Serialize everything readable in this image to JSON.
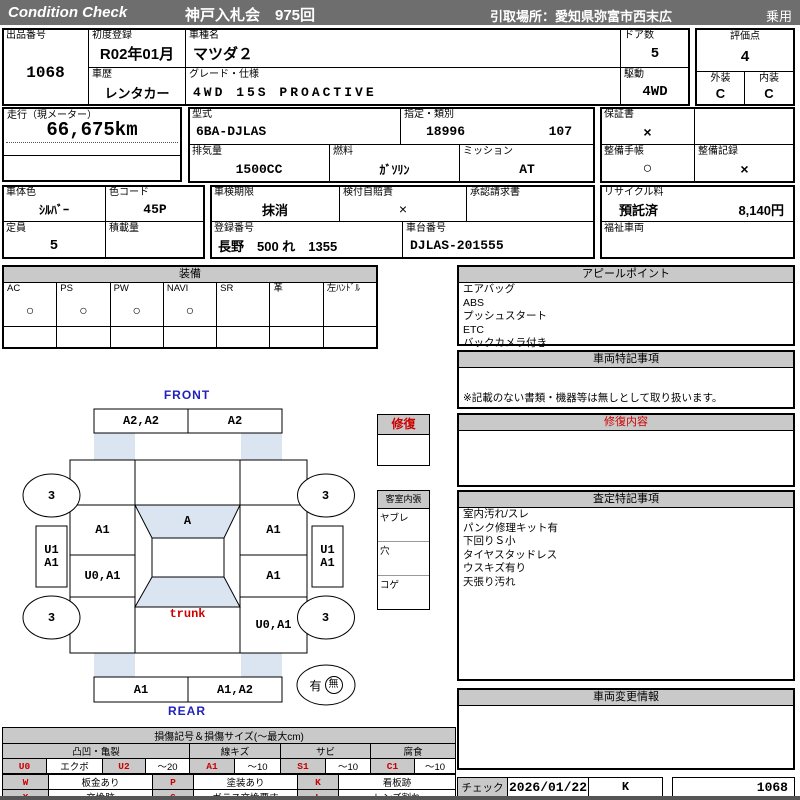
{
  "topbar": {
    "brand": "Condition  Check",
    "auction": "神戸入札会　975回",
    "pickup": "引取場所：愛知県弥富市西末広",
    "category": "乗用"
  },
  "row1": {
    "lot_label": "出品番号",
    "lot": "1068",
    "first_reg_label": "初度登録",
    "first_reg": "R02年01月",
    "history_label": "車歴",
    "history": "レンタカー",
    "model_label": "車種名",
    "model": "マツダ２",
    "grade_label": "グレード・仕様",
    "grade": "4WD 15S PROACTIVE",
    "doors_label": "ドア数",
    "doors": "5",
    "drive_label": "駆動",
    "drive": "4WD",
    "score_label": "評価点",
    "score": "4",
    "exterior_label": "外装",
    "exterior": "C",
    "interior_label": "内装",
    "interior": "C"
  },
  "row2": {
    "mileage_label": "走行（現メーター）",
    "mileage": "66,675km",
    "model_code_label": "型式",
    "model_code": "6BA-DJLAS",
    "class_label": "指定・類別",
    "class1": "18996",
    "class2": "107",
    "displacement_label": "排気量",
    "displacement": "1500CC",
    "fuel_label": "燃料",
    "fuel": "ｶﾞｿﾘﾝ",
    "mission_label": "ミッション",
    "mission": "AT",
    "warranty_label": "保証書",
    "warranty": "×",
    "book_label": "整備手帳",
    "book": "○",
    "record_label": "整備記録",
    "record": "×"
  },
  "row3": {
    "body_color_label": "車体色",
    "body_color": "ｼﾙﾊﾞｰ",
    "color_code_label": "色コード",
    "color_code": "45P",
    "capacity_label": "定員",
    "capacity": "5",
    "load_label": "積載量",
    "inspection_label": "車検期限",
    "inspection": "抹消",
    "insurance_label": "検付自賠責",
    "insurance": "×",
    "approval_label": "承認請求書",
    "plate_label": "登録番号",
    "plate": "長野　500 れ　1355",
    "chassis_label": "車台番号",
    "chassis": "DJLAS-201555",
    "recycle_label": "リサイクル料",
    "recycle_status": "預託済",
    "recycle_fee": "8,140円",
    "welfare_label": "福祉車両"
  },
  "equipment": {
    "title": "装備",
    "items": [
      {
        "label": "AC",
        "mark": "○"
      },
      {
        "label": "PS",
        "mark": "○"
      },
      {
        "label": "PW",
        "mark": "○"
      },
      {
        "label": "NAVI",
        "mark": "○"
      },
      {
        "label": "SR",
        "mark": ""
      },
      {
        "label": "革",
        "mark": ""
      },
      {
        "label": "左ﾊﾝﾄﾞﾙ",
        "mark": ""
      }
    ]
  },
  "panels": {
    "appeal": {
      "title": "アピールポイント",
      "items": [
        "エアバッグ",
        "ABS",
        "プッシュスタート",
        "ETC",
        "バックカメラ付き"
      ]
    },
    "notes": {
      "title": "車両特記事項",
      "note": "※記載のない書類・機器等は無しとして取り扱います。"
    },
    "repair": {
      "title": "修復内容"
    },
    "assessment": {
      "title": "査定特記事項",
      "items": [
        "室内汚れ/スレ",
        "パンク修理キット有",
        "下回りＳ小",
        "タイヤスタッドレス",
        "ウスキズ有り",
        "天張り汚れ"
      ]
    },
    "change": {
      "title": "車両変更情報"
    }
  },
  "check": {
    "label": "チェック",
    "date": "2026/01/22",
    "inspector": "K",
    "number": "1068"
  },
  "diagram": {
    "front": "FRONT",
    "rear": "REAR",
    "front_bumper_left": "A2,A2",
    "front_bumper_right": "A2",
    "rear_bumper_left": "A1",
    "rear_bumper_right": "A1,A2",
    "wheel_front_left": "3",
    "wheel_front_right": "3",
    "wheel_rear_left": "3",
    "wheel_rear_right": "3",
    "side_left_top": "U1",
    "side_left_bottom": "A1",
    "side_right_top": "U1",
    "side_right_bottom": "A1",
    "front_fender_left": "A1",
    "windshield": "A",
    "front_fender_right": "A1",
    "door_left": "U0,A1",
    "door_right": "A1",
    "trunk": "trunk",
    "rear_fender_right": "U0,A1",
    "presence_yes": "有",
    "presence_no": "無",
    "repair_box_title": "修復",
    "cabin_title": "客室内張",
    "cabin_items": [
      "ヤブレ",
      "穴",
      "コゲ"
    ]
  },
  "legend": {
    "title": "損傷記号＆損傷サイズ(～最大cm)",
    "groups": [
      "凸凹・亀裂",
      "線キズ",
      "サビ",
      "腐食"
    ],
    "row1": [
      {
        "code": "U0",
        "desc": "エクボ"
      },
      {
        "code": "U2",
        "desc": "～20"
      },
      {
        "code": "A1",
        "desc": "～10"
      },
      {
        "code": "S1",
        "desc": "～10"
      },
      {
        "code": "C1",
        "desc": "～10"
      }
    ],
    "row2": [
      {
        "code": "U1",
        "desc": "～10"
      },
      {
        "code": "U3",
        "desc": "20超"
      },
      {
        "code": "A2",
        "desc": "10超"
      },
      {
        "code": "S2",
        "desc": "10超"
      },
      {
        "code": "C2",
        "desc": "10超"
      }
    ],
    "marks1": [
      {
        "code": "W",
        "desc": "板金あり"
      },
      {
        "code": "P",
        "desc": "塗装あり"
      },
      {
        "code": "K",
        "desc": "看板跡"
      }
    ],
    "marks2": [
      {
        "code": "X",
        "desc": "交換跡"
      },
      {
        "code": "G",
        "desc": "ガラス交換要す"
      },
      {
        "code": "L",
        "desc": "レンズ割れ"
      }
    ]
  }
}
